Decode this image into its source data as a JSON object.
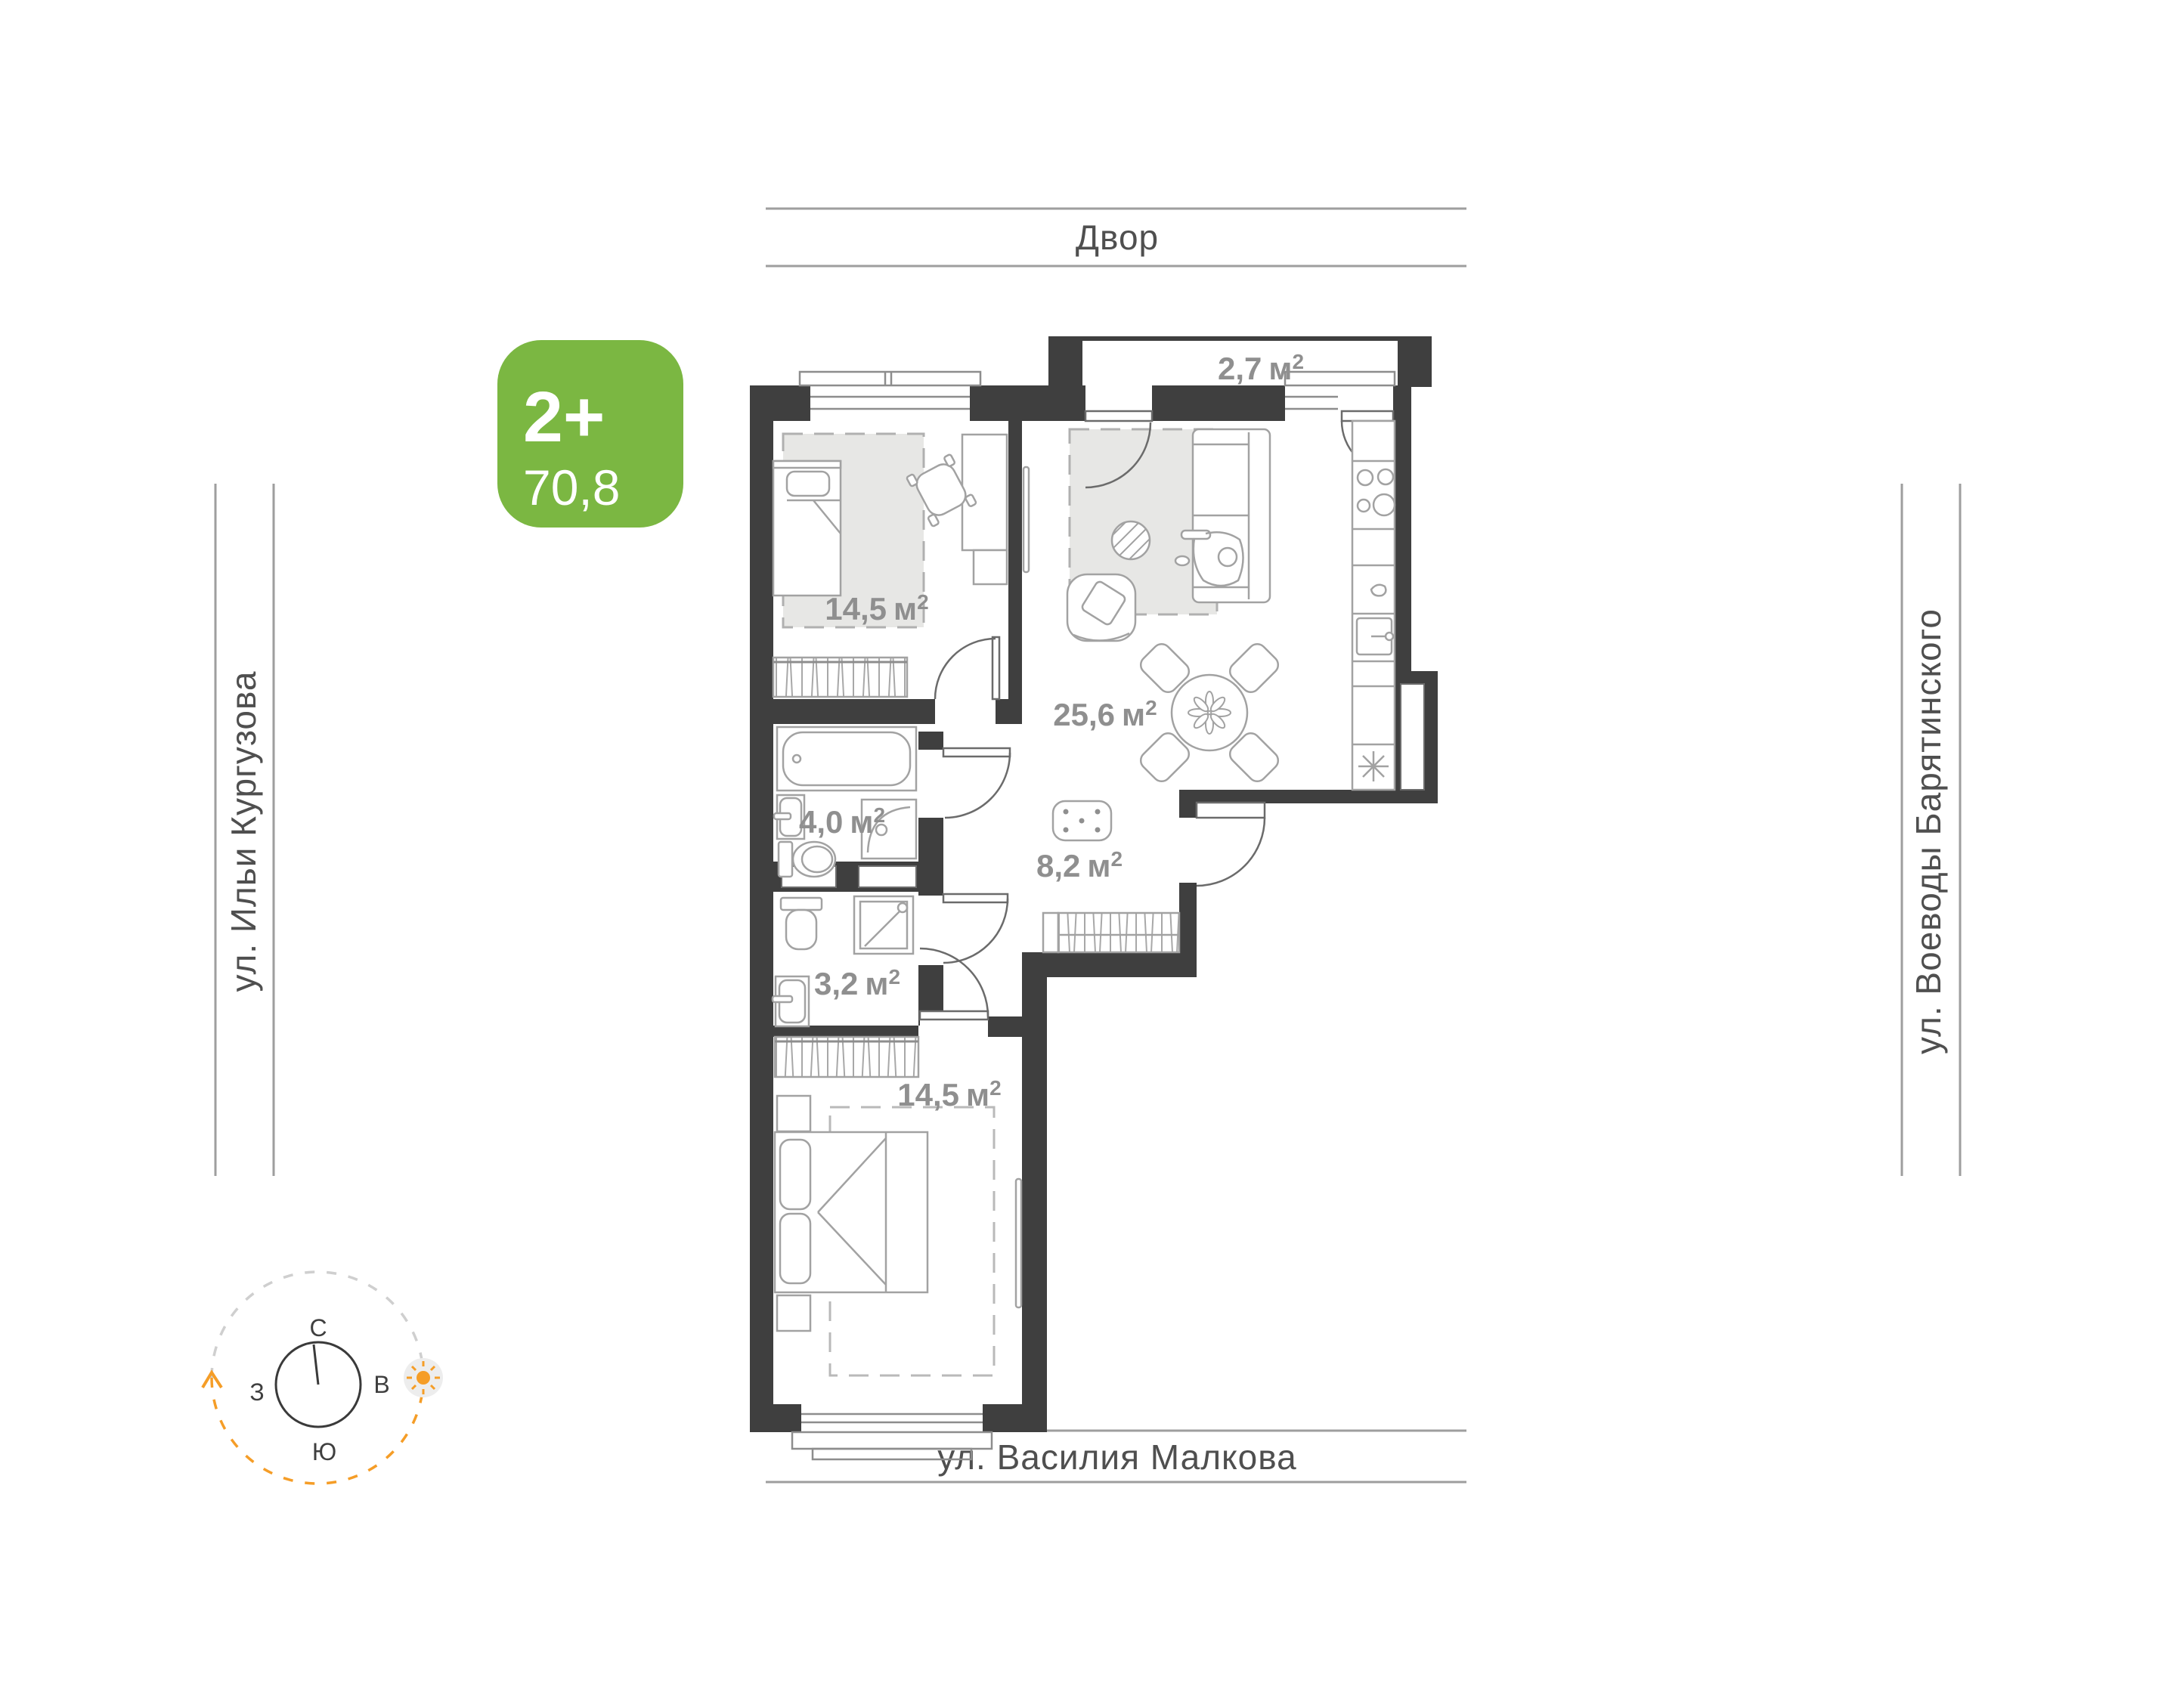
{
  "plan_card": {
    "badge": {
      "rooms_label": "2+",
      "area_value": "70,8",
      "color": "#7bb742"
    },
    "surroundings": {
      "top": "Двор",
      "left": "ул. Ильи Кургузова",
      "right": "ул. Воеводы Барятинского",
      "bottom": "ул. Василия Малкова"
    },
    "rooms": [
      {
        "name": "bedroom-1",
        "area": "14,5",
        "unit": "м",
        "sup": "2"
      },
      {
        "name": "living-kitchen",
        "area": "25,6",
        "unit": "м",
        "sup": "2"
      },
      {
        "name": "balcony",
        "area": "2,7",
        "unit": "м",
        "sup": "2"
      },
      {
        "name": "bathroom",
        "area": "4,0",
        "unit": "м",
        "sup": "2"
      },
      {
        "name": "hallway",
        "area": "8,2",
        "unit": "м",
        "sup": "2"
      },
      {
        "name": "shower-room",
        "area": "3,2",
        "unit": "м",
        "sup": "2"
      },
      {
        "name": "bedroom-2",
        "area": "14,5",
        "unit": "м",
        "sup": "2"
      }
    ],
    "compass": {
      "north": "С",
      "east": "В",
      "south": "Ю",
      "west": "З"
    },
    "colors": {
      "wall": "#3f3f3f",
      "badge": "#7bb742",
      "furniture": "#a2a2a2",
      "room_label": "#8f8f8f",
      "street_text": "#4f4f4f",
      "street_line": "#9e9e9e",
      "sun": "#f59d27",
      "rug": "#e7e7e5"
    }
  }
}
